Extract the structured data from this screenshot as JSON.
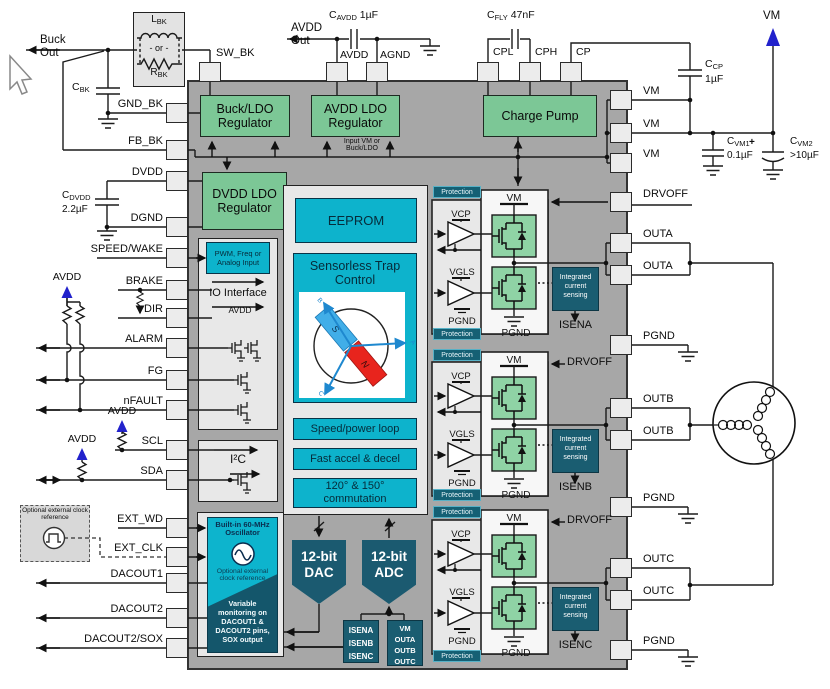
{
  "colors": {
    "green": "#7cc796",
    "cyan": "#0db3cc",
    "teal": "#1a5d71",
    "chip_gray": "#a7a7a7",
    "container_gray": "#e8e8e8",
    "fet_green": "#8fd3a5",
    "wire": "#1b1b1b",
    "blue_arrow": "#2222cc",
    "rotor_blue": "#41aee8",
    "rotor_red": "#e8241d"
  },
  "pins": {
    "sw_bk": "SW_BK",
    "avdd": "AVDD",
    "agnd": "AGND",
    "cpl": "CPL",
    "cph": "CPH",
    "cp": "CP",
    "gnd_bk": "GND_BK",
    "fb_bk": "FB_BK",
    "dvdd": "DVDD",
    "dgnd": "DGND",
    "speed_wake": "SPEED/WAKE",
    "brake": "BRAKE",
    "dir": "DIR",
    "alarm": "ALARM",
    "fg": "FG",
    "nfault": "nFAULT",
    "scl": "SCL",
    "sda": "SDA",
    "ext_wd": "EXT_WD",
    "ext_clk": "EXT_CLK",
    "dacout1": "DACOUT1",
    "dacout2": "DACOUT2",
    "dacout2_sox": "DACOUT2/SOX",
    "vm": "VM",
    "drvoff": "DRVOFF",
    "outa": "OUTA",
    "outb": "OUTB",
    "outc": "OUTC",
    "pgnd": "PGND"
  },
  "external": {
    "buck_out": [
      "Buck",
      "Out"
    ],
    "avdd_out": [
      "AVDD",
      "Out"
    ],
    "l_bk": {
      "p": "L",
      "s": "BK"
    },
    "or_label": "- or -",
    "r_bk": {
      "p": "R",
      "s": "BK"
    },
    "c_bk": {
      "p": "C",
      "s": "BK"
    },
    "c_avdd": {
      "p": "C",
      "s": "AVDD",
      "v": "1µF"
    },
    "c_fly": {
      "p": "C",
      "s": "FLY",
      "v": "47nF"
    },
    "c_cp": {
      "p": "C",
      "s": "CP",
      "v": "1µF"
    },
    "c_vm1": {
      "p": "C",
      "s": "VM1",
      "v": "0.1µF"
    },
    "c_vm2": {
      "p": "C",
      "s": "VM2",
      "v": ">10µF",
      "plus": "+"
    },
    "c_dvdd": {
      "p": "C",
      "s": "DVDD",
      "v": "2.2µF"
    },
    "vm_net": "VM",
    "avdd_net": "AVDD",
    "optional_clock": "Optional external clock reference"
  },
  "blocks": {
    "buck_ldo": "Buck/LDO Regulator",
    "avdd_ldo": "AVDD LDO Regulator",
    "charge_pump": "Charge Pump",
    "dvdd_ldo": "DVDD LDO Regulator",
    "input_note": "Input VM or Buck/LDO",
    "pwm_input": "PWM, Freq or Analog Input",
    "io_interface": "IO Interface",
    "io_avdd": "AVDD",
    "eeprom": "EEPROM",
    "sensorless": "Sensorless Trap Control",
    "speed_loop": "Speed/power loop",
    "fast_accel": "Fast accel & decel",
    "commutation": "120° & 150° commutation",
    "i2c": "I²C",
    "oscillator": "Built-in 60-MHz Oscillator",
    "osc_optional": "Optional external clock reference",
    "monitoring": "Variable monitoring on DACOUT1 & DACOUT2 pins, SOX output",
    "dac": "12-bit DAC",
    "adc": "12-bit ADC",
    "isen_list": [
      "ISENA",
      "ISENB",
      "ISENC"
    ],
    "vm_out_list": [
      "VM",
      "OUTA",
      "OUTB",
      "OUTC"
    ],
    "protection": "Protection",
    "current_sense": "Integrated current sensing",
    "vcp": "VCP",
    "vgls": "VGLS",
    "vm_int": "VM",
    "pgnd_int": "PGND",
    "drvoff_int": "DRVOFF",
    "isena": "ISENA",
    "isenb": "ISENB",
    "isenc": "ISENC"
  },
  "rotor": {
    "s": "S",
    "n": "N",
    "a": "A",
    "b": "B",
    "c": "C"
  }
}
